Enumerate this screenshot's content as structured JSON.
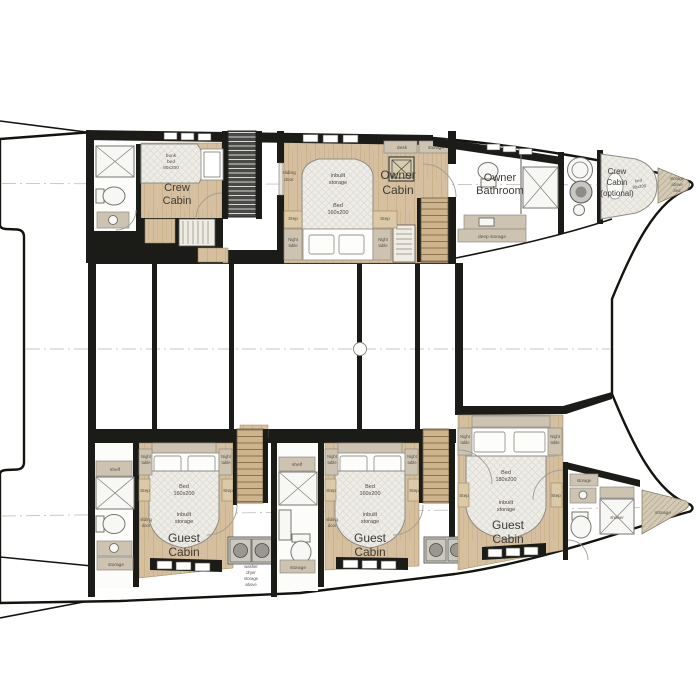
{
  "plan_type": "catamaran lower deck floor plan",
  "colors": {
    "wall": "#1b1b18",
    "wood_floor": "#d5bf9e",
    "furniture_beige": "#cdc3b0",
    "mattress": "#edece6",
    "background": "#ffffff"
  },
  "labels": {
    "crew": "Crew",
    "cabin": "Cabin",
    "optional": "(optional)",
    "owner": "Owner",
    "bathroom": "Bathroom",
    "guest": "Guest",
    "bed": "Bed",
    "bed_lc": "bed",
    "bunk": "bunk",
    "size80": "80x200",
    "size160": "160x200",
    "size180": "180x200",
    "inbuilt": "inbuilt",
    "storage": "storage",
    "night": "Night",
    "table": "table",
    "step": "Step",
    "sliding": "sliding",
    "door": "door",
    "shelf": "shelf",
    "desk": "desk",
    "deep_storage": "deep storage",
    "shower": "shower",
    "washer": "washer",
    "dryer": "dryer",
    "above": "above"
  },
  "rooms": [
    "Crew Cabin",
    "Owner Cabin",
    "Owner Bathroom",
    "Crew Cabin (optional)",
    "Guest Cabin",
    "Guest Cabin",
    "Guest Cabin"
  ]
}
